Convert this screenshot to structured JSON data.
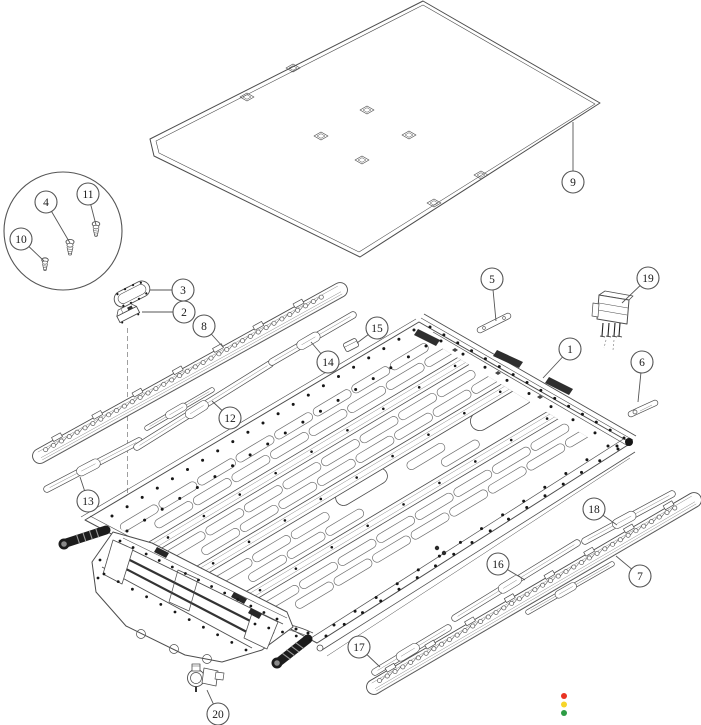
{
  "diagram": {
    "type": "exploded-parts-diagram",
    "background": "#ffffff",
    "line_color": "#4d4d4d",
    "dark_color": "#161616",
    "callout_style": {
      "radius": 11,
      "font_size": 11.5
    },
    "callouts": [
      {
        "label": "9",
        "cx": 573,
        "cy": 182,
        "lx": 573,
        "ly": 122
      },
      {
        "label": "10",
        "cx": 21,
        "cy": 239,
        "lx": 44,
        "ly": 261
      },
      {
        "label": "4",
        "cx": 46,
        "cy": 202,
        "lx": 70,
        "ly": 243
      },
      {
        "label": "11",
        "cx": 88,
        "cy": 194,
        "lx": 96,
        "ly": 225
      },
      {
        "label": "3",
        "cx": 183,
        "cy": 290,
        "lx": 150,
        "ly": 290
      },
      {
        "label": "2",
        "cx": 184,
        "cy": 312,
        "lx": 142,
        "ly": 312
      },
      {
        "label": "8",
        "cx": 204,
        "cy": 326,
        "lx": 223,
        "ly": 347
      },
      {
        "label": "12",
        "cx": 230,
        "cy": 418,
        "lx": 212,
        "ly": 401
      },
      {
        "label": "13",
        "cx": 88,
        "cy": 501,
        "lx": 80,
        "ly": 477
      },
      {
        "label": "14",
        "cx": 328,
        "cy": 362,
        "lx": 311,
        "ly": 342
      },
      {
        "label": "15",
        "cx": 377,
        "cy": 328,
        "lx": 357,
        "ly": 343
      },
      {
        "label": "5",
        "cx": 492,
        "cy": 279,
        "lx": 496,
        "ly": 321
      },
      {
        "label": "19",
        "cx": 648,
        "cy": 278,
        "lx": 622,
        "ly": 303
      },
      {
        "label": "1",
        "cx": 570,
        "cy": 349,
        "lx": 543,
        "ly": 378
      },
      {
        "label": "6",
        "cx": 642,
        "cy": 362,
        "lx": 638,
        "ly": 402
      },
      {
        "label": "16",
        "cx": 498,
        "cy": 564,
        "lx": 525,
        "ly": 580
      },
      {
        "label": "17",
        "cx": 359,
        "cy": 647,
        "lx": 380,
        "ly": 667
      },
      {
        "label": "18",
        "cx": 594,
        "cy": 509,
        "lx": 617,
        "ly": 525
      },
      {
        "label": "7",
        "cx": 640,
        "cy": 576,
        "lx": 616,
        "ly": 556
      },
      {
        "label": "20",
        "cx": 218,
        "cy": 714,
        "lx": 207,
        "ly": 690
      }
    ],
    "status_dots": [
      {
        "name": "red",
        "color": "#e93323",
        "cx": 564,
        "cy": 696,
        "r": 3
      },
      {
        "name": "yellow",
        "color": "#f6d52a",
        "cx": 564,
        "cy": 704.5,
        "r": 3
      },
      {
        "name": "green",
        "color": "#2d9c44",
        "cx": 564,
        "cy": 713,
        "r": 3
      }
    ]
  }
}
